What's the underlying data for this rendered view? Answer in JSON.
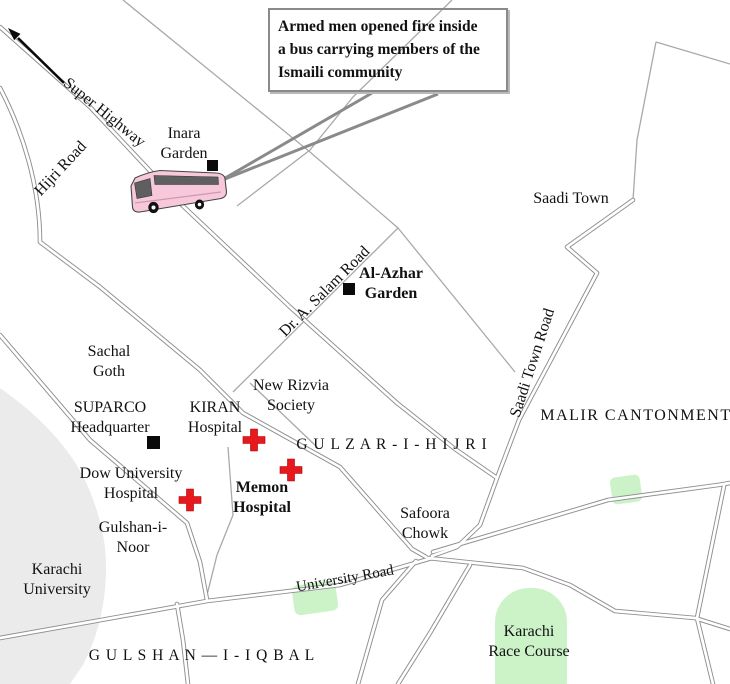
{
  "callout": {
    "line1": "Armed men opened fire inside",
    "line2": "a bus carrying members of the",
    "line3": "Ismaili community"
  },
  "roads": {
    "super_highway": "Super Highway",
    "hijri_road": "Hijri Road",
    "dr_a_salam_road": "Dr. A. Salam Road",
    "saadi_town_road": "Saadi Town Road",
    "university_road": "University Road"
  },
  "places": {
    "inara": {
      "l1": "Inara",
      "l2": "Garden"
    },
    "saadi_town": "Saadi Town",
    "al_azhar": {
      "l1": "Al-Azhar",
      "l2": "Garden"
    },
    "malir": "MALIR CANTONMENT",
    "sachal": {
      "l1": "Sachal",
      "l2": "Goth"
    },
    "suparco": {
      "l1": "SUPARCO",
      "l2": "Headquarter"
    },
    "kiran": {
      "l1": "KIRAN",
      "l2": "Hospital"
    },
    "new_rizvia": {
      "l1": "New Rizvia",
      "l2": "Society"
    },
    "gulzar": "G U L Z A R - I - H I J R I",
    "dow": {
      "l1": "Dow University",
      "l2": "Hospital"
    },
    "memon": {
      "l1": "Memon",
      "l2": "Hospital"
    },
    "gulshan_noor": {
      "l1": "Gulshan-i-",
      "l2": "Noor"
    },
    "safoora": {
      "l1": "Safoora",
      "l2": "Chowk"
    },
    "karachi_uni": {
      "l1": "Karachi",
      "l2": "University"
    },
    "gulshan_iqbal": "G U L S H A N — I - I Q B A L",
    "race_course": {
      "l1": "Karachi",
      "l2": "Race Course"
    }
  },
  "markers": {
    "inara_garden": "black-square-marker",
    "al_azhar_garden": "black-square-marker",
    "suparco": "black-square-marker",
    "kiran_hospital": "red-cross-marker",
    "memon_hospital": "red-cross-marker",
    "dow_hospital": "red-cross-marker",
    "incident_bus": "pink-bus-illustration",
    "highway_direction": "northwest-arrow"
  },
  "colors": {
    "road_casing": "#8f8f8f",
    "thin_road": "#a9a9a9",
    "park_green": "#ccf3c7",
    "campus_gray": "#ebebeb",
    "bus_pink": "#f6c8da",
    "bus_window": "#5f5f5f",
    "cross_red": "#e8191c",
    "marker_black": "#0a0a0a",
    "text": "#111111"
  }
}
